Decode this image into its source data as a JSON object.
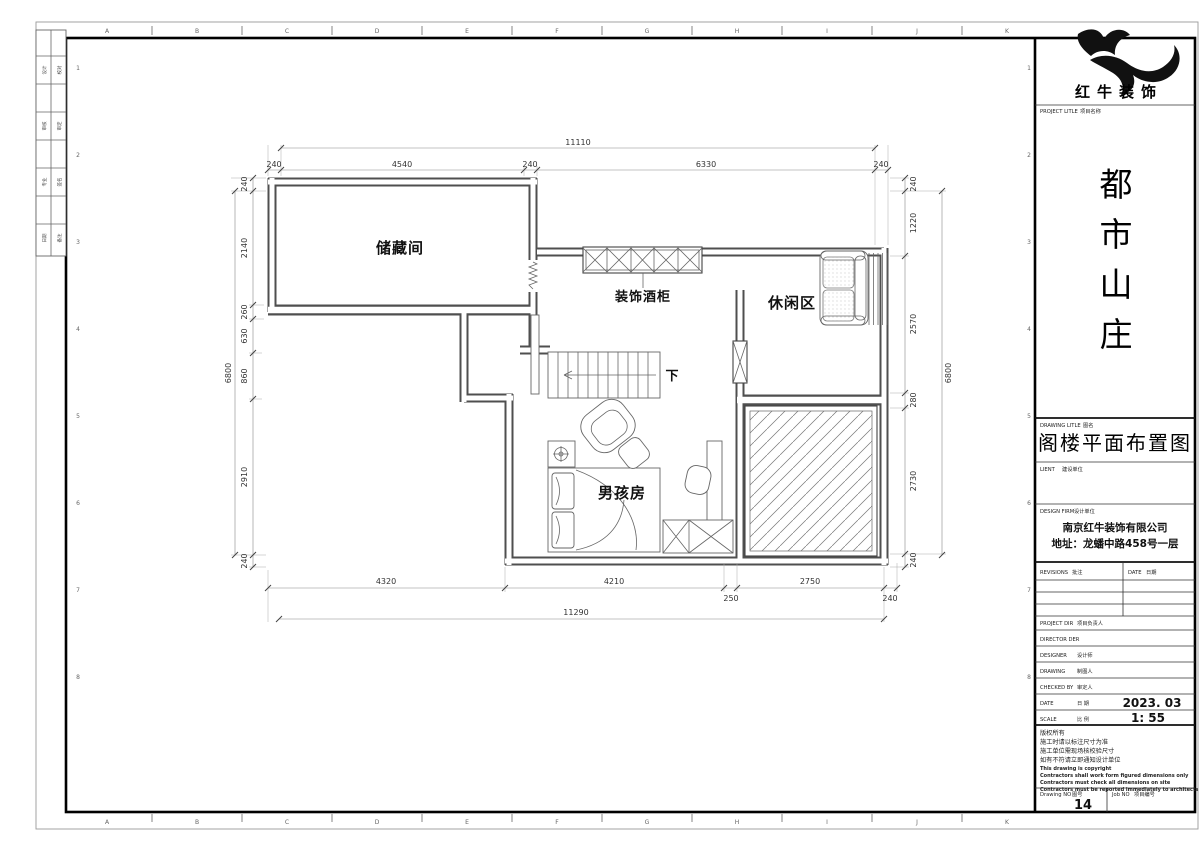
{
  "sheet": {
    "ruler_letters": [
      "A",
      "B",
      "C",
      "D",
      "E",
      "F",
      "G",
      "H",
      "I",
      "J",
      "K"
    ],
    "ruler_numbers": [
      "1",
      "2",
      "3",
      "4",
      "5",
      "6",
      "7",
      "8"
    ],
    "signoff_rows": [
      {
        "c1": "设计",
        "c2": "校对"
      },
      {
        "c1": "审核",
        "c2": "审定"
      },
      {
        "c1": "专业",
        "c2": "签名"
      },
      {
        "c1": "日期",
        "c2": "备注"
      }
    ]
  },
  "plan": {
    "room_storage": "储藏间",
    "room_leisure": "休闲区",
    "room_boy": "男孩房",
    "wine_cabinet_label": "装饰酒柜",
    "stairs_down_label": "下",
    "dims": {
      "top_overall": "11110",
      "top_chain": [
        "240",
        "4540",
        "240",
        "6330",
        "240"
      ],
      "left_overall": "6800",
      "left_chain": [
        "240",
        "2140",
        "260",
        "630",
        "860",
        "2910",
        "240"
      ],
      "right_overall": "6800",
      "right_chain": [
        "240",
        "1220",
        "2570",
        "280",
        "2730",
        "240"
      ],
      "bottom_overall": "11290",
      "bottom_chain": [
        "4320",
        "4210",
        "250",
        "2750",
        "240"
      ]
    }
  },
  "title_block": {
    "logo_name": "红牛装饰",
    "project_label": "PROJECT LITLE",
    "project_label_cn": "项目名称",
    "project_chars": [
      "都",
      "市",
      "山",
      "庄"
    ],
    "drawing_label": "DRAWING LITLE",
    "drawing_label_cn": "图名",
    "drawing_title": "阁楼平面布置图",
    "client_label": "LIENT",
    "client_label_cn": "建设单位",
    "firm_label": "DESIGN FIRM",
    "firm_label_cn": "设计单位",
    "firm_name": "南京红牛装饰有限公司",
    "firm_address": "地址：龙蟠中路458号一层",
    "revisions_label": "REVISIONS",
    "revisions_label_cn": "批注",
    "date_col_label": "DATE",
    "date_col_label_cn": "日期",
    "rows": [
      {
        "en": "PROJECT DIR",
        "cn": "项目负责人",
        "value": ""
      },
      {
        "en": "DIRECTOR DER",
        "cn": "",
        "value": ""
      },
      {
        "en": "DESIGNER",
        "cn": "设计师",
        "value": ""
      },
      {
        "en": "DRAWING",
        "cn": "制图人",
        "value": ""
      },
      {
        "en": "CHECKED BY",
        "cn": "审定人",
        "value": ""
      },
      {
        "en": "DATE",
        "cn": "日 期",
        "value": "2023. 03"
      },
      {
        "en": "SCALE",
        "cn": "比 例",
        "value": "1: 55"
      }
    ],
    "notes_cn": [
      "版权所有",
      "施工时请以标注尺寸为准",
      "施工单位需现场核校验尺寸",
      "如有不符请立即通知设计单位"
    ],
    "notes_en": [
      "This drawing is copyright",
      "Contractors shall work form figured dimensions only",
      "Contractors must check all dimensions on site",
      "Contractors must be reported immediately to architects"
    ],
    "drawing_no_label": "Drawing NO",
    "drawing_no_label_cn": "图号",
    "drawing_no": "14",
    "job_no_label": "Job NO",
    "job_no_label_cn": "项目编号"
  }
}
